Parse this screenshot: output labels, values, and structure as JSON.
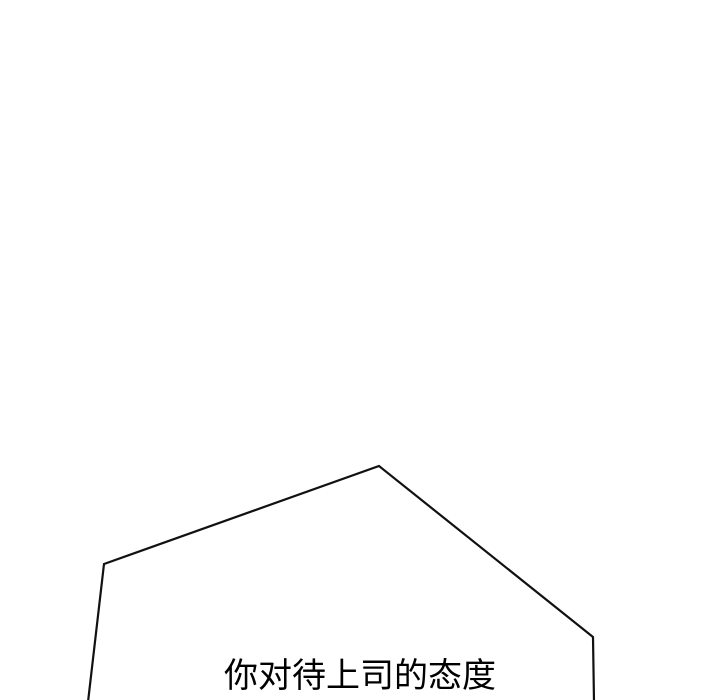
{
  "page": {
    "background_color": "#ffffff"
  },
  "panel": {
    "description": "comic panel with angular speech bubble cut off at bottom edge",
    "speech_bubble": {
      "text": "你对待上司的态度",
      "outline_color": "#111111",
      "fill_color": "#ffffff",
      "text_color": "#000000"
    }
  }
}
